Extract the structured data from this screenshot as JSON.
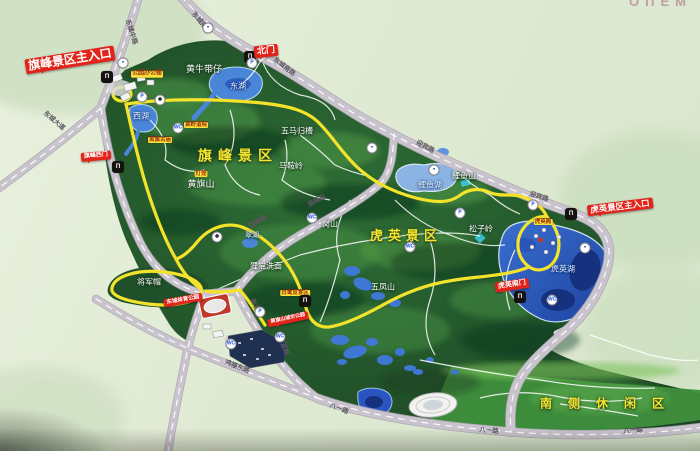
{
  "meta": {
    "corner_text": "OПEM"
  },
  "colors": {
    "board": "#e3ecd8",
    "park_dark": "#1c4a26",
    "park_mid": "#2f6b33",
    "south_area": "#3f8f3d",
    "road": "#c9c3cd",
    "route_yellow": "#f4e32b",
    "lake": "#4a86d8",
    "lake_deep": "#1d3f9a",
    "banner_red": "#e1251b",
    "spot_label_bg": "#f8e13b",
    "spot_label_text": "#9c2b0e"
  },
  "banners": [
    {
      "id": "banner-qifeng-main-entrance",
      "text": "旗峰景区主入口",
      "x": 70,
      "y": 60,
      "rot": -9,
      "fs": 12
    },
    {
      "id": "banner-north-gate",
      "text": "北门",
      "x": 266,
      "y": 51,
      "rot": -6,
      "fs": 9
    },
    {
      "id": "banner-qifeng-west-gate",
      "text": "旗峰西门",
      "x": 96,
      "y": 156,
      "rot": -5,
      "fs": 6
    },
    {
      "id": "banner-huying-main-entrance",
      "text": "虎英景区主入口",
      "x": 620,
      "y": 207,
      "rot": -7,
      "fs": 8.5
    },
    {
      "id": "banner-huying-south-gate",
      "text": "虎英南门",
      "x": 512,
      "y": 285,
      "rot": -8,
      "fs": 7
    },
    {
      "id": "banner-dongcheng-sports-park",
      "text": "东城体育公园",
      "x": 183,
      "y": 300,
      "rot": -10,
      "fs": 5.5
    },
    {
      "id": "banner-huangqishan-city-park",
      "text": "黄旗山城市公园",
      "x": 288,
      "y": 319,
      "rot": -12,
      "fs": 5
    }
  ],
  "area_titles": [
    {
      "id": "area-title-qifeng",
      "text": "旗峰景区",
      "x": 238,
      "y": 156,
      "fs": 14,
      "ls": 6
    },
    {
      "id": "area-title-huying",
      "text": "虎英景区",
      "x": 406,
      "y": 236,
      "fs": 13,
      "ls": 5
    },
    {
      "id": "area-title-south-leisure",
      "text": "南侧休闲区",
      "x": 610,
      "y": 404,
      "fs": 12,
      "ls": 16
    }
  ],
  "terrain_labels": [
    {
      "text": "黄牛带仔",
      "x": 204,
      "y": 70,
      "fs": 9
    },
    {
      "text": "五马归槽",
      "x": 297,
      "y": 132,
      "fs": 8
    },
    {
      "text": "马鞍岭",
      "x": 291,
      "y": 167,
      "fs": 8
    },
    {
      "text": "黄旗山",
      "x": 201,
      "y": 185,
      "fs": 9
    },
    {
      "text": "岗山",
      "x": 330,
      "y": 225,
      "fs": 8
    },
    {
      "text": "鲤鱼山",
      "x": 464,
      "y": 177,
      "fs": 8
    },
    {
      "text": "松子岭",
      "x": 481,
      "y": 230,
      "fs": 8
    },
    {
      "text": "五凤山",
      "x": 383,
      "y": 288,
      "fs": 8
    },
    {
      "text": "狸猫洗面",
      "x": 266,
      "y": 267,
      "fs": 8
    },
    {
      "text": "将军帽",
      "x": 149,
      "y": 283,
      "fs": 8
    }
  ],
  "water_labels": [
    {
      "text": "东湖",
      "x": 238,
      "y": 87,
      "fs": 8
    },
    {
      "text": "西湖",
      "x": 141,
      "y": 117,
      "fs": 8
    },
    {
      "text": "鲤鱼湖",
      "x": 430,
      "y": 186,
      "fs": 8
    },
    {
      "text": "虎英湖",
      "x": 563,
      "y": 270,
      "fs": 8
    },
    {
      "text": "翠湖",
      "x": 252,
      "y": 236,
      "fs": 7
    }
  ],
  "road_labels": [
    {
      "text": "东城中路",
      "x": 131,
      "y": 32,
      "rot": 72,
      "fs": 6.5
    },
    {
      "text": "东城南路",
      "x": 201,
      "y": 23,
      "rot": 50,
      "fs": 6.5
    },
    {
      "text": "东城南路",
      "x": 284,
      "y": 67,
      "rot": 38,
      "fs": 6.5
    },
    {
      "text": "东城大道",
      "x": 54,
      "y": 121,
      "rot": 40,
      "fs": 6.5
    },
    {
      "text": "迎宾路",
      "x": 425,
      "y": 147,
      "rot": 28,
      "fs": 6.5
    },
    {
      "text": "迎宾路",
      "x": 539,
      "y": 197,
      "rot": 18,
      "fs": 6.5
    },
    {
      "text": "旗峰路",
      "x": 258,
      "y": 222,
      "rot": -30,
      "fs": 6.5
    },
    {
      "text": "旗峰路",
      "x": 317,
      "y": 201,
      "rot": -28,
      "fs": 6.5
    },
    {
      "text": "新源路",
      "x": 256,
      "y": 308,
      "rot": 63,
      "fs": 6.5
    },
    {
      "text": "新源路",
      "x": 283,
      "y": 346,
      "rot": 68,
      "fs": 6.5
    },
    {
      "text": "鸿福东路",
      "x": 237,
      "y": 367,
      "rot": 21,
      "fs": 6.5
    },
    {
      "text": "八一路",
      "x": 339,
      "y": 409,
      "rot": 22,
      "fs": 6.5
    },
    {
      "text": "八一路",
      "x": 489,
      "y": 431,
      "rot": 5,
      "fs": 6.5
    },
    {
      "text": "八一路",
      "x": 633,
      "y": 431,
      "rot": -4,
      "fs": 6.5
    }
  ],
  "spot_labels": [
    {
      "text": "公园办公楼",
      "x": 147,
      "y": 74,
      "fs": 6
    },
    {
      "text": "黄岭道院",
      "x": 196,
      "y": 125,
      "fs": 5.5
    },
    {
      "text": "黄旗古庙",
      "x": 160,
      "y": 140,
      "fs": 5.5
    },
    {
      "text": "灯笼",
      "x": 201,
      "y": 174,
      "fs": 5.5
    },
    {
      "text": "白鹭觅食区",
      "x": 295,
      "y": 293,
      "fs": 5.5
    },
    {
      "text": "虎英阁",
      "x": 543,
      "y": 222,
      "fs": 5.5
    }
  ],
  "icons": [
    {
      "kind": "gate-icon",
      "x": 107,
      "y": 77
    },
    {
      "kind": "gate-icon",
      "x": 250,
      "y": 57
    },
    {
      "kind": "gate-icon",
      "x": 118,
      "y": 167
    },
    {
      "kind": "gate-icon",
      "x": 571,
      "y": 214
    },
    {
      "kind": "gate-icon",
      "x": 520,
      "y": 297
    },
    {
      "kind": "gate-icon",
      "x": 305,
      "y": 301
    },
    {
      "kind": "bus-icon",
      "x": 208,
      "y": 28
    },
    {
      "kind": "bus-icon",
      "x": 123,
      "y": 63
    },
    {
      "kind": "bus-icon",
      "x": 372,
      "y": 148
    },
    {
      "kind": "bus-icon",
      "x": 434,
      "y": 170
    },
    {
      "kind": "bus-icon",
      "x": 585,
      "y": 248
    },
    {
      "kind": "parking-icon",
      "x": 252,
      "y": 63
    },
    {
      "kind": "parking-icon",
      "x": 142,
      "y": 97
    },
    {
      "kind": "parking-icon",
      "x": 533,
      "y": 205
    },
    {
      "kind": "parking-icon",
      "x": 460,
      "y": 213
    },
    {
      "kind": "parking-icon",
      "x": 260,
      "y": 312
    },
    {
      "kind": "toilet-icon",
      "x": 178,
      "y": 128
    },
    {
      "kind": "toilet-icon",
      "x": 312,
      "y": 218
    },
    {
      "kind": "toilet-icon",
      "x": 552,
      "y": 300
    },
    {
      "kind": "toilet-icon",
      "x": 231,
      "y": 344
    },
    {
      "kind": "toilet-icon",
      "x": 410,
      "y": 247
    },
    {
      "kind": "toilet-icon",
      "x": 280,
      "y": 337
    },
    {
      "kind": "cable-car-icon",
      "x": 217,
      "y": 237
    },
    {
      "kind": "cable-car-icon",
      "x": 160,
      "y": 100
    }
  ]
}
